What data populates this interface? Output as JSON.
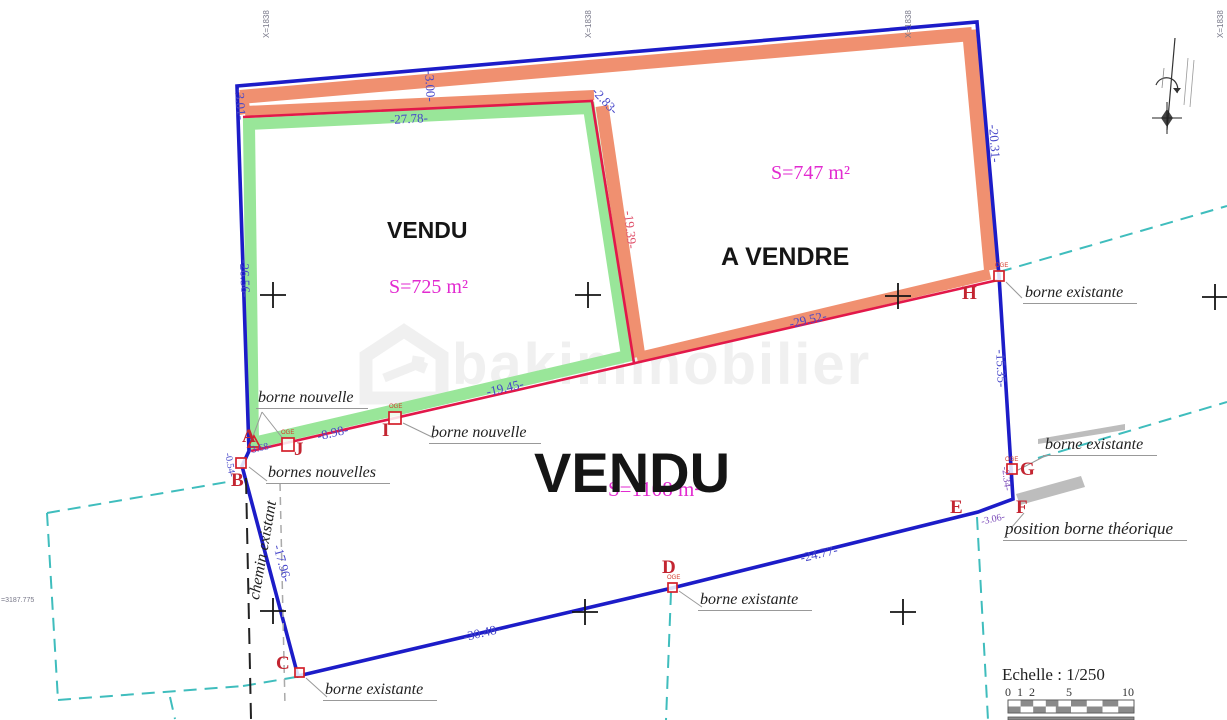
{
  "parcels": {
    "vendu_left": {
      "name": "VENDU",
      "area": "S=725 m²"
    },
    "a_vendre": {
      "name": "A VENDRE",
      "area": "S=747 m²"
    },
    "vendu_bottom": {
      "name": "VENDU",
      "area": "S=1108 m²"
    }
  },
  "points": {
    "A": "A",
    "B": "B",
    "C": "C",
    "D": "D",
    "E": "E",
    "F": "F",
    "G": "G",
    "H": "H",
    "I": "I",
    "J": "J"
  },
  "marker_tag": "OGE",
  "dims": {
    "left_top": "-3.01-",
    "strip_mid": "-3.00-",
    "green_top": "-27.78-",
    "strip_corner": "-2.83-",
    "shared_edge": "-19.39-",
    "right_top": "-20.31-",
    "left_mid": "-26.56-",
    "red_right": "-29.52-",
    "red_mid": "-19.45-",
    "red_j_i": "-8.98-",
    "red_a_j": "-3.68-",
    "b_offset": "-0.54-",
    "right_mid": "-15.35-",
    "g_corner": "-2.34-",
    "e_f": "-3.06-",
    "b_c": "-17.96-",
    "c_d": "-30.48-",
    "d_e": "-24.77-"
  },
  "notes": {
    "borne_nouvelle": "borne nouvelle",
    "bornes_nouvelles": "bornes nouvelles",
    "borne_existante": "borne existante",
    "position_borne_theorique": "position borne théorique",
    "chemin_existant": "chemin existant"
  },
  "coords": {
    "top": [
      "X=1838",
      "X=1838",
      "X=1838",
      "X=1838"
    ],
    "left": "=3187.775"
  },
  "scale": {
    "title": "Echelle : 1/250",
    "ticks": [
      "0",
      "1",
      "2",
      "5",
      "10"
    ]
  },
  "watermark": "bakimmobilier",
  "colors": {
    "boundary_blue": "#1c1cc8",
    "new_limit_red": "#e2184a",
    "parcel_green": "#99e699",
    "parcel_orange": "#f09070",
    "area_magenta": "#e22ad0",
    "cyan_dashed": "#3fbdbd"
  }
}
